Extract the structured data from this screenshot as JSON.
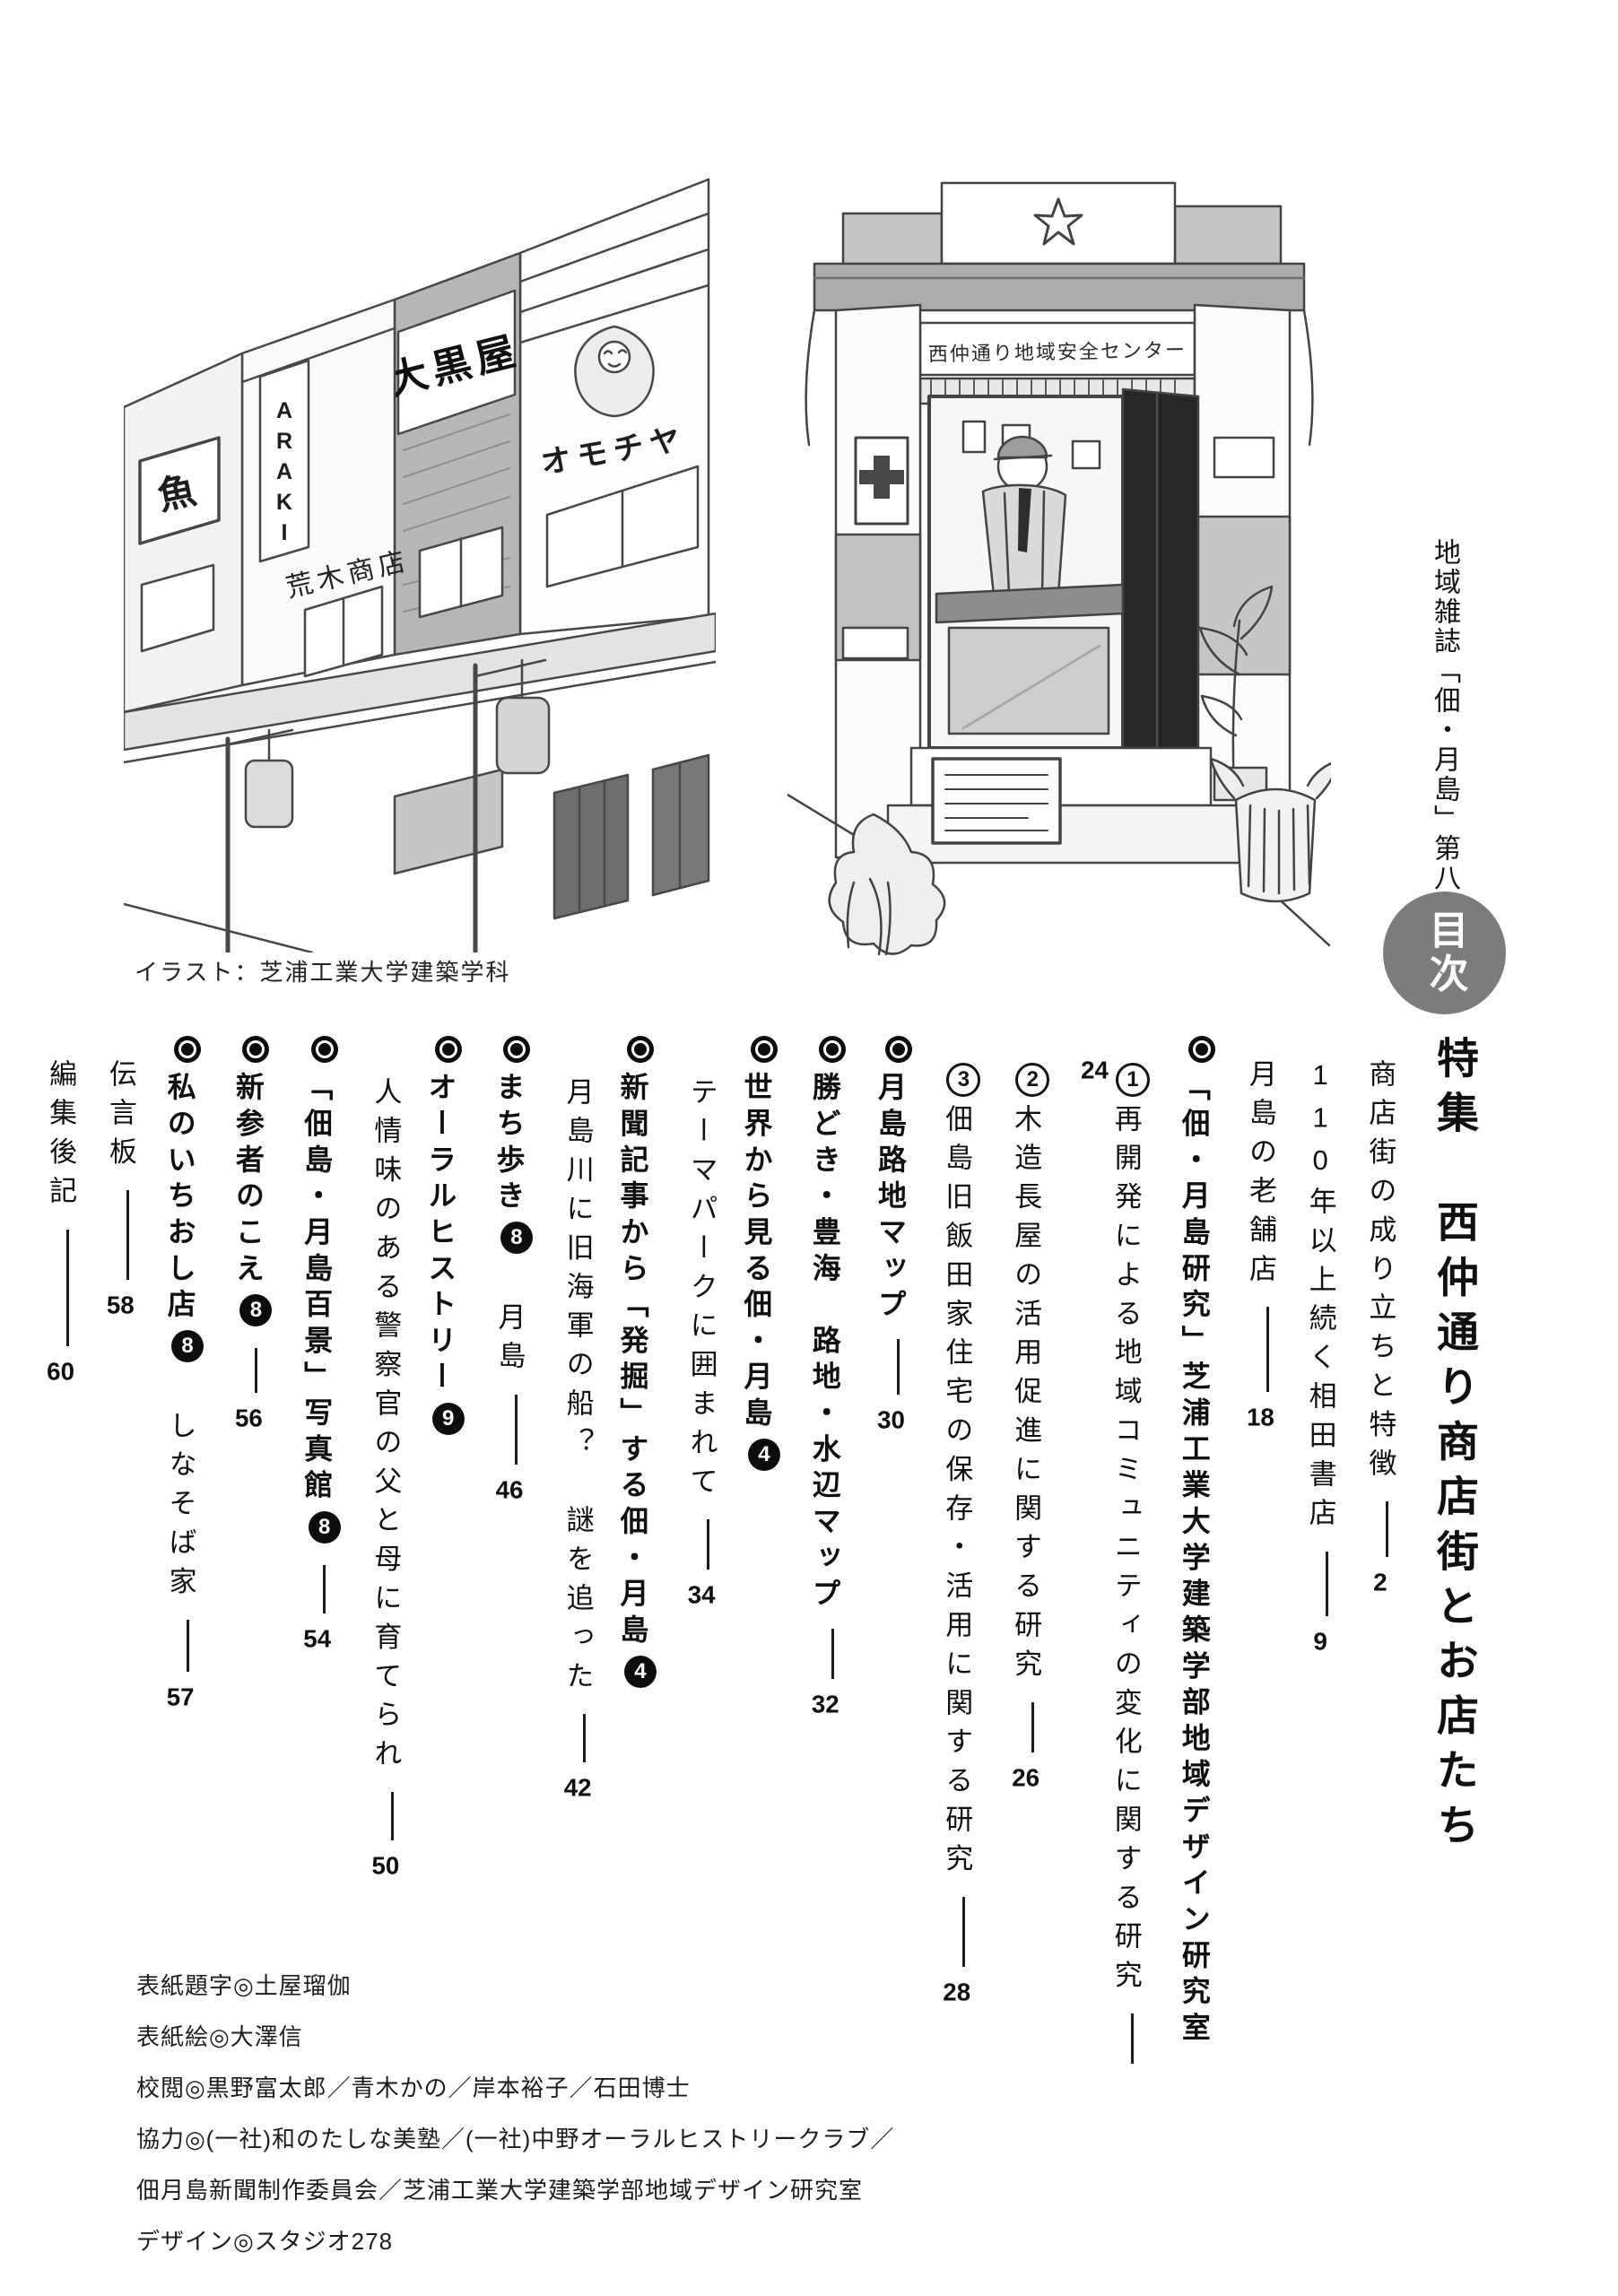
{
  "page": {
    "edition_label": "地域雑誌「佃・月島」第八号",
    "toc_badge": "目次",
    "illustration_caption": "イラスト：芝浦工業大学建築学科"
  },
  "illustrations": {
    "street": {
      "fish_sign": "魚",
      "araki_sign": "ARAKI",
      "araki_store_sign": "荒木商店",
      "daikokuya_sign": "大黒屋",
      "toy_sign": "オモチヤ"
    },
    "kiosk": {
      "sign": "西仲通り地域安全センター"
    }
  },
  "toc": {
    "title": "特集　西仲通り商店街とお店たち",
    "items": [
      {
        "label": "商店街の成り立ちと特徴",
        "page": "2"
      },
      {
        "label": "110年以上続く相田書店",
        "page": "9"
      },
      {
        "label": "月島の老舗店",
        "page": "18"
      },
      {
        "label": "「佃・月島研究」芝浦工業大学建築学部地域デザイン研究室"
      },
      {
        "num": "1",
        "label": "再開発による地域コミュニティの変化に関する研究",
        "page": "24"
      },
      {
        "num": "2",
        "label": "木造長屋の活用促進に関する研究",
        "page": "26"
      },
      {
        "num": "3",
        "label": "佃島旧飯田家住宅の保存・活用に関する研究",
        "page": "28"
      },
      {
        "label": "月島路地マップ",
        "page": "30"
      },
      {
        "label": "勝どき・豊海　路地・水辺マップ",
        "page": "32"
      },
      {
        "label": "世界から見る佃・月島",
        "num": "4"
      },
      {
        "label": "テーマパークに囲まれて",
        "page": "34"
      },
      {
        "label": "新聞記事から「発掘」する佃・月島",
        "num": "4"
      },
      {
        "label": "月島川に旧海軍の船？　謎を追った",
        "page": "42"
      },
      {
        "label": "まち歩き",
        "num": "8",
        "label2": "月島",
        "page": "46"
      },
      {
        "label": "オーラルヒストリー",
        "num": "9"
      },
      {
        "label": "人情味のある警察官の父と母に育てられ",
        "page": "50"
      },
      {
        "label": "「佃島・月島百景」写真館",
        "num": "8",
        "page": "54"
      },
      {
        "label": "新参者のこえ",
        "num": "8",
        "page": "56"
      },
      {
        "label": "私のいちおし店",
        "num": "8",
        "label2": "しなそば家",
        "page": "57"
      },
      {
        "label": "伝言板",
        "page": "58"
      },
      {
        "label": "編集後記",
        "page": "60"
      }
    ]
  },
  "credits": {
    "lines": [
      "表紙題字◎土屋瑠伽",
      "表紙絵◎大澤信",
      "校閲◎黒野富太郎／青木かの／岸本裕子／石田博士",
      "協力◎(一社)和のたしな美塾／(一社)中野オーラルヒストリークラブ／",
      "佃月島新聞制作委員会／芝浦工業大学建築学部地域デザイン研究室",
      "デザイン◎スタジオ278"
    ]
  }
}
